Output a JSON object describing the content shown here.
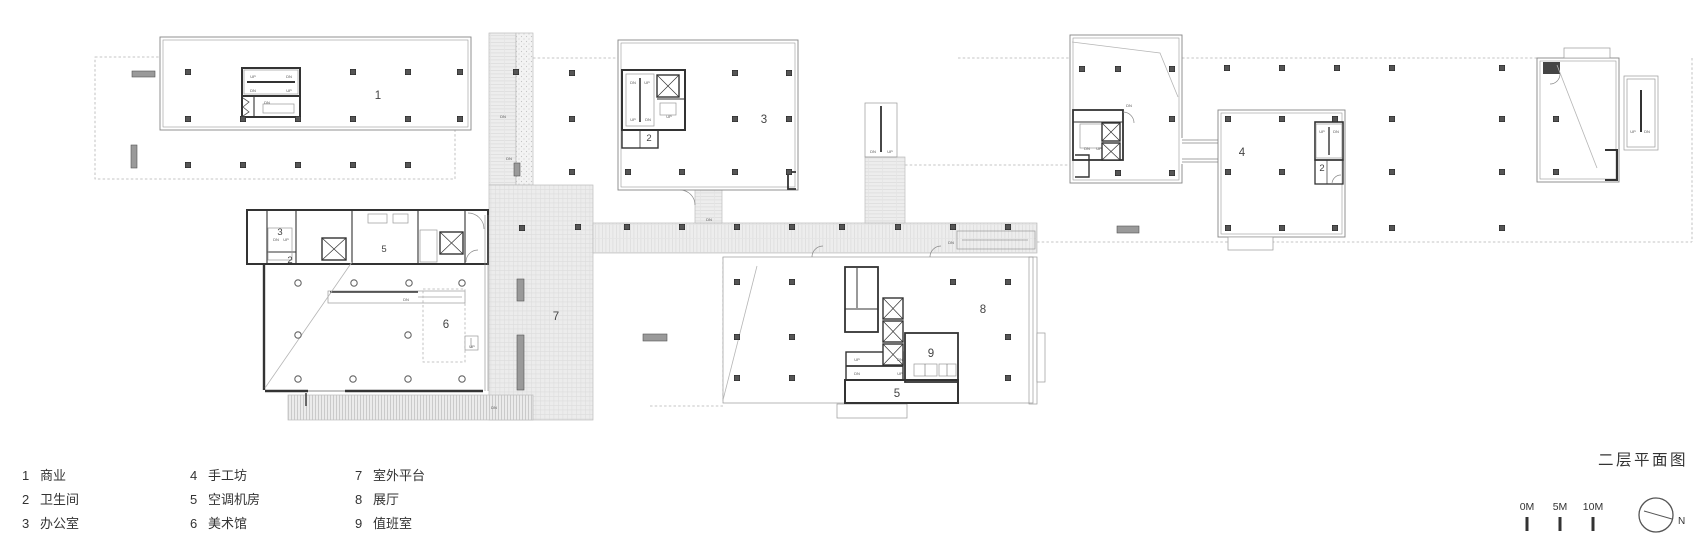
{
  "title": "二层平面图",
  "legend": {
    "items": [
      {
        "num": "1",
        "label": "商业"
      },
      {
        "num": "2",
        "label": "卫生间"
      },
      {
        "num": "3",
        "label": "办公室"
      },
      {
        "num": "4",
        "label": "手工坊"
      },
      {
        "num": "5",
        "label": "空调机房"
      },
      {
        "num": "6",
        "label": "美术馆"
      },
      {
        "num": "7",
        "label": "室外平台"
      },
      {
        "num": "8",
        "label": "展厅"
      },
      {
        "num": "9",
        "label": "值班室"
      }
    ]
  },
  "scale_bar": {
    "labels": [
      "0M",
      "5M",
      "10M"
    ]
  },
  "north": {
    "label": "N"
  },
  "colors": {
    "background": "#ffffff",
    "wall_dark": "#333333",
    "line_gray": "#8a8a8a",
    "paving": "#ededed",
    "text": "#333333"
  },
  "plan": {
    "room_labels": [
      {
        "t": "1",
        "x": 378,
        "y": 99,
        "s": "big"
      },
      {
        "t": "3",
        "x": 764,
        "y": 123,
        "s": "big"
      },
      {
        "t": "2",
        "x": 649,
        "y": 141,
        "s": "small"
      },
      {
        "t": "4",
        "x": 1242,
        "y": 156,
        "s": "big"
      },
      {
        "t": "2",
        "x": 1322,
        "y": 171,
        "s": "small"
      },
      {
        "t": "3",
        "x": 280,
        "y": 235,
        "s": "small"
      },
      {
        "t": "2",
        "x": 290,
        "y": 263,
        "s": "small"
      },
      {
        "t": "5",
        "x": 384,
        "y": 252,
        "s": "small"
      },
      {
        "t": "6",
        "x": 446,
        "y": 328,
        "s": "big"
      },
      {
        "t": "7",
        "x": 556,
        "y": 320,
        "s": "big"
      },
      {
        "t": "8",
        "x": 983,
        "y": 313,
        "s": "big"
      },
      {
        "t": "9",
        "x": 931,
        "y": 357,
        "s": "big"
      },
      {
        "t": "5",
        "x": 897,
        "y": 397,
        "s": "big"
      }
    ],
    "stair_labels": [
      {
        "t": "UP",
        "x": 253,
        "y": 78
      },
      {
        "t": "DN",
        "x": 289,
        "y": 78
      },
      {
        "t": "DN",
        "x": 253,
        "y": 92
      },
      {
        "t": "UP",
        "x": 289,
        "y": 92
      },
      {
        "t": "DN",
        "x": 267,
        "y": 104
      },
      {
        "t": "DN",
        "x": 633,
        "y": 84
      },
      {
        "t": "UP",
        "x": 647,
        "y": 84
      },
      {
        "t": "UP",
        "x": 633,
        "y": 121
      },
      {
        "t": "DN",
        "x": 648,
        "y": 121
      },
      {
        "t": "UP",
        "x": 669,
        "y": 118
      },
      {
        "t": "DN",
        "x": 503,
        "y": 118
      },
      {
        "t": "DN",
        "x": 509,
        "y": 160
      },
      {
        "t": "DN",
        "x": 276,
        "y": 241
      },
      {
        "t": "UP",
        "x": 286,
        "y": 241
      },
      {
        "t": "DN",
        "x": 406,
        "y": 301
      },
      {
        "t": "DN",
        "x": 494,
        "y": 409
      },
      {
        "t": "DN",
        "x": 709,
        "y": 221
      },
      {
        "t": "DN",
        "x": 873,
        "y": 153
      },
      {
        "t": "UP",
        "x": 890,
        "y": 153
      },
      {
        "t": "DN",
        "x": 951,
        "y": 244
      },
      {
        "t": "DN",
        "x": 1129,
        "y": 107
      },
      {
        "t": "DN",
        "x": 1087,
        "y": 150
      },
      {
        "t": "UP",
        "x": 1099,
        "y": 150
      },
      {
        "t": "UP",
        "x": 1322,
        "y": 133
      },
      {
        "t": "DN",
        "x": 1336,
        "y": 133
      },
      {
        "t": "UP",
        "x": 1633,
        "y": 133
      },
      {
        "t": "DN",
        "x": 1647,
        "y": 133
      },
      {
        "t": "UP",
        "x": 857,
        "y": 361
      },
      {
        "t": "DN",
        "x": 900,
        "y": 361
      },
      {
        "t": "DN",
        "x": 857,
        "y": 375
      },
      {
        "t": "UP",
        "x": 900,
        "y": 375
      },
      {
        "t": "UP",
        "x": 472,
        "y": 348
      }
    ]
  }
}
